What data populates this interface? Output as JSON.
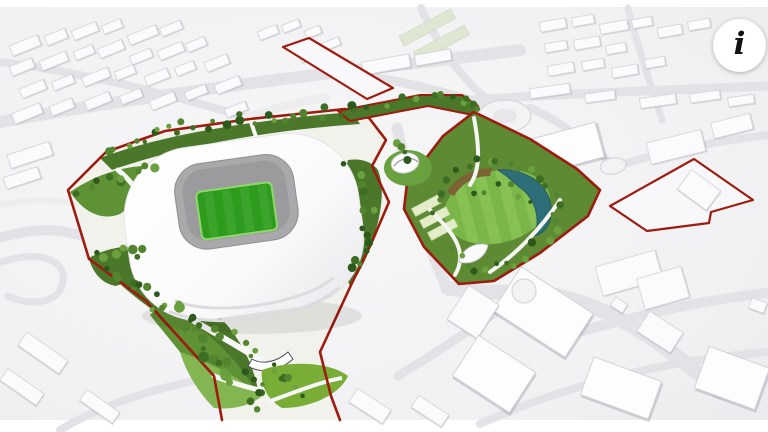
{
  "ui": {
    "info_button": {
      "glyph": "i",
      "icon": "info-icon"
    }
  },
  "colors": {
    "boundary_red": "#9e1b10",
    "park_green": "#5d8a33",
    "landscape_green_dark": "#4a7729",
    "pitch_green": "#2f9b1e",
    "lawn_green": "#7ab648",
    "teal_canopy": "#2e6e78",
    "leaf_green": "#79ad36",
    "building_white": "#fbfbfd",
    "road_gray": "#e2e2e7",
    "ground_gray": "#f1f1f3"
  }
}
